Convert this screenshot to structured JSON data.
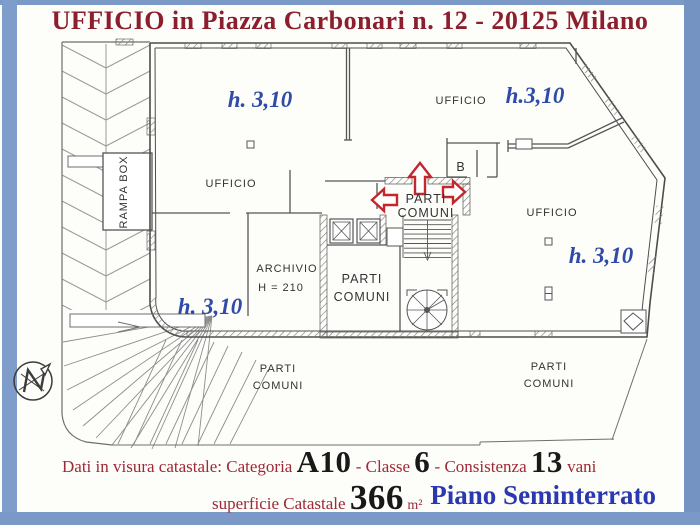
{
  "title": {
    "text": "UFFICIO in Piazza Carbonari n. 12 - 20125 Milano",
    "color": "#8c1e2e"
  },
  "plan": {
    "heights": {
      "top_left": "h. 3,10",
      "top_right": "h.3,10",
      "right": "h. 3,10",
      "bottom_left": "h. 3,10"
    },
    "rooms": {
      "ufficio_top_left": "UFFICIO",
      "ufficio_top_right": "UFFICIO",
      "ufficio_right": "UFFICIO",
      "rampa_box": "RAMPA BOX",
      "archivio": "ARCHIVIO",
      "archivio_height": "H = 210",
      "room_b": "B",
      "parti_comuni_line1": "PARTI",
      "parti_comuni_line2": "COMUNI"
    },
    "compass": {
      "letter": "N"
    },
    "height_label_color": "#2f4aa8",
    "arrow_color": "#c1272d"
  },
  "footer": {
    "line1": {
      "intro": "Dati in visura catastale: Categoria ",
      "categoria_value": "A10",
      "classe_label": " - Classe ",
      "classe_value": "6",
      "consistenza_label": " - Consistenza ",
      "consistenza_value": "13",
      "vani_label": " vani"
    },
    "line2": {
      "superficie_label": "superficie Catastale ",
      "superficie_value": "366",
      "unit": " m²",
      "piano": "Piano Seminterrato"
    },
    "red_color": "#a02837",
    "blue_color": "#2b38b0"
  }
}
